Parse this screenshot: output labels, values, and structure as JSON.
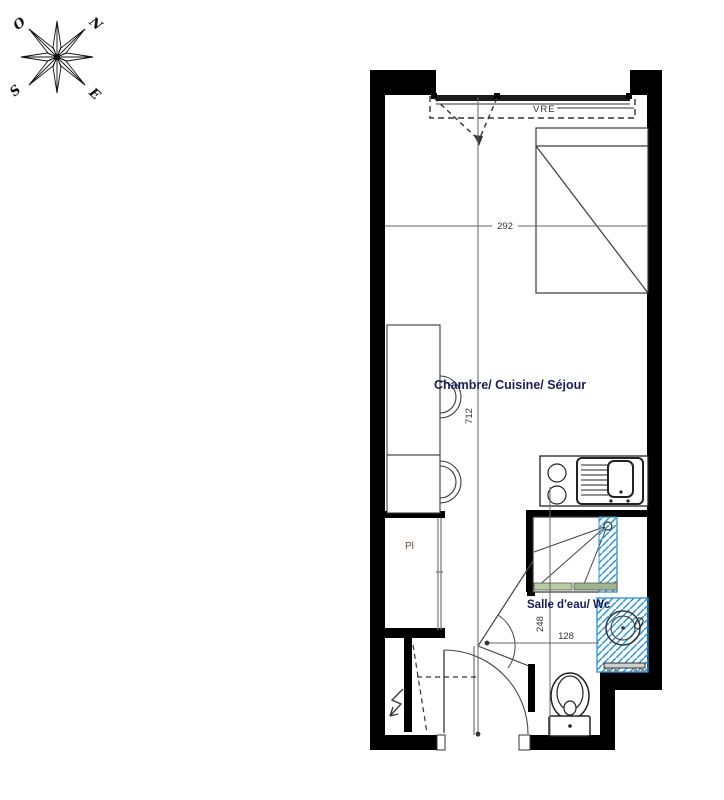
{
  "compass": {
    "west": "O",
    "north": "N",
    "south": "S",
    "east": "E"
  },
  "labels": {
    "window_shutter": "VRE",
    "main_room": "Chambre/ Cuisine/ Séjour",
    "bathroom": "Salle d'eau/ Wc",
    "closet": "Pl"
  },
  "dimensions": {
    "room_length": "712",
    "room_width": "292",
    "bathroom_length": "248",
    "bathroom_width": "128"
  },
  "colors": {
    "wall": "#000000",
    "line": "#444444",
    "dimension_line": "#666666",
    "room_label": "#1c1c55",
    "hatch_blue": "#2b93cf",
    "threshold_green_light": "#b8cba3",
    "threshold_green_dark": "#9fb48e"
  }
}
